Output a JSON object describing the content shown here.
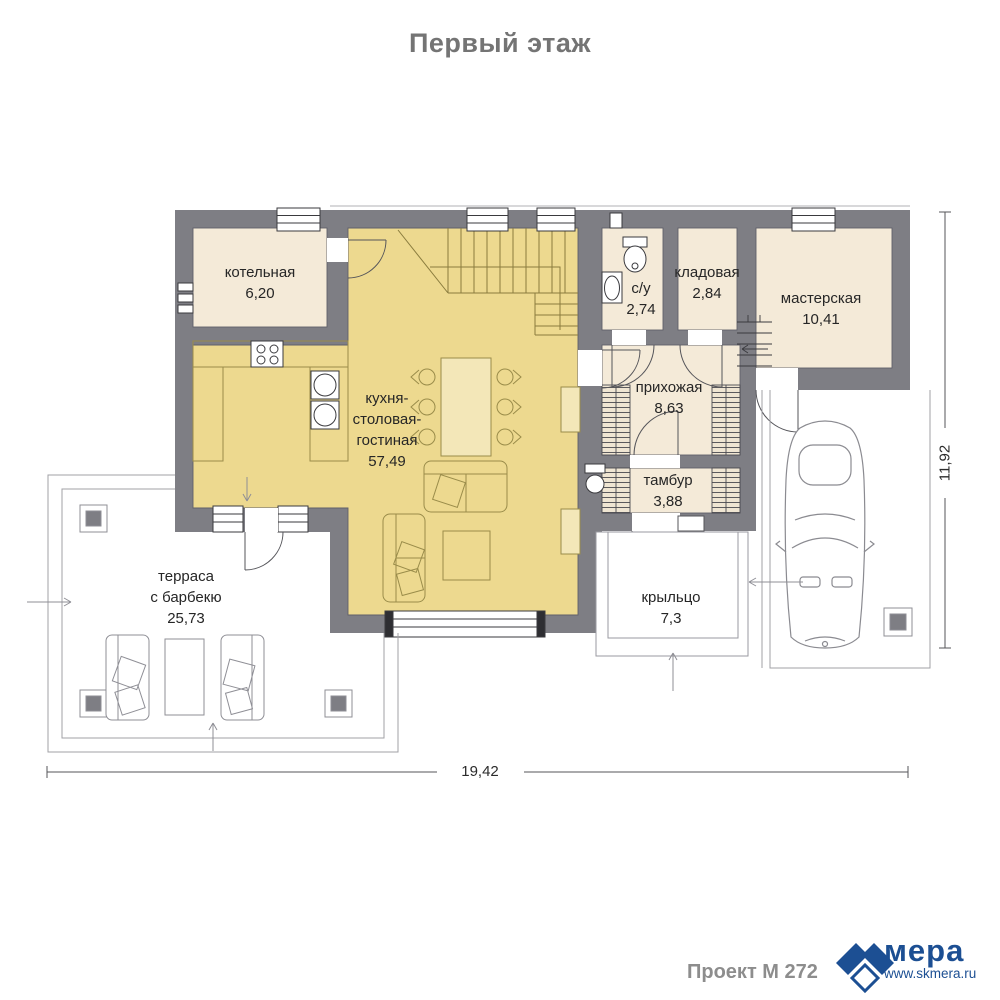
{
  "header": {
    "title": "Первый этаж"
  },
  "rooms": {
    "boiler": {
      "name": "котельная",
      "area": "6,20"
    },
    "kitchen": {
      "line1": "кухня-",
      "line2": "столовая-",
      "line3": "гостиная",
      "area": "57,49"
    },
    "bathroom": {
      "name": "с/у",
      "area": "2,74"
    },
    "storage": {
      "name": "кладовая",
      "area": "2,84"
    },
    "workshop": {
      "name": "мастерская",
      "area": "10,41"
    },
    "hallway": {
      "name": "прихожая",
      "area": "8,63"
    },
    "vestibule": {
      "name": "тамбур",
      "area": "3,88"
    },
    "terrace": {
      "line1": "терраса",
      "line2": "с барбекю",
      "area": "25,73"
    },
    "porch": {
      "name": "крыльцо",
      "area": "7,3"
    }
  },
  "dimensions": {
    "width": "19,42",
    "height": "11,92"
  },
  "footer": {
    "project": "Проект М 272",
    "brand": "мера",
    "website": "www.skmera.ru"
  },
  "colors": {
    "wall": "#7e7e84",
    "room_fill": "#f4ead8",
    "kitchen_fill": "#edd98f",
    "brand_blue": "#1c4f93",
    "title_gray": "#747474"
  }
}
